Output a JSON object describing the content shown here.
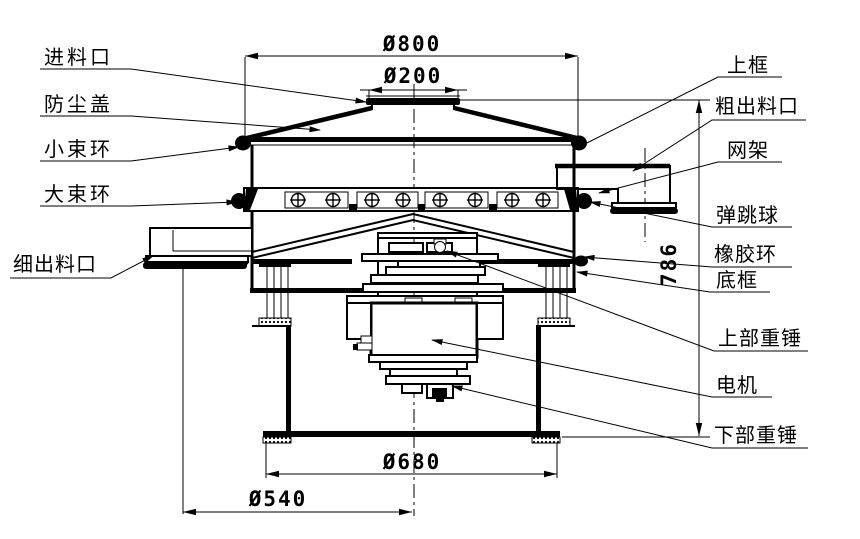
{
  "diagram": {
    "type": "rotary-vibrating-screen-technical-drawing",
    "colors": {
      "line": "#000000",
      "background": "#ffffff"
    },
    "labels": {
      "left": [
        {
          "text": "进料口"
        },
        {
          "text": "防尘盖"
        },
        {
          "text": "小束环"
        },
        {
          "text": "大束环"
        },
        {
          "text": "细出料口"
        }
      ],
      "right": [
        {
          "text": "上框"
        },
        {
          "text": "粗出料口"
        },
        {
          "text": "网架"
        },
        {
          "text": "弹跳球"
        },
        {
          "text": "橡胶环"
        },
        {
          "text": "底框"
        },
        {
          "text": "上部重锤"
        },
        {
          "text": "电机"
        },
        {
          "text": "下部重锤"
        }
      ]
    },
    "dimensions": {
      "top_diameter": "Ø800",
      "inlet_diameter": "Ø200",
      "total_height": "786",
      "base_outer_diameter": "Ø680",
      "base_inner_diameter": "Ø540"
    }
  }
}
